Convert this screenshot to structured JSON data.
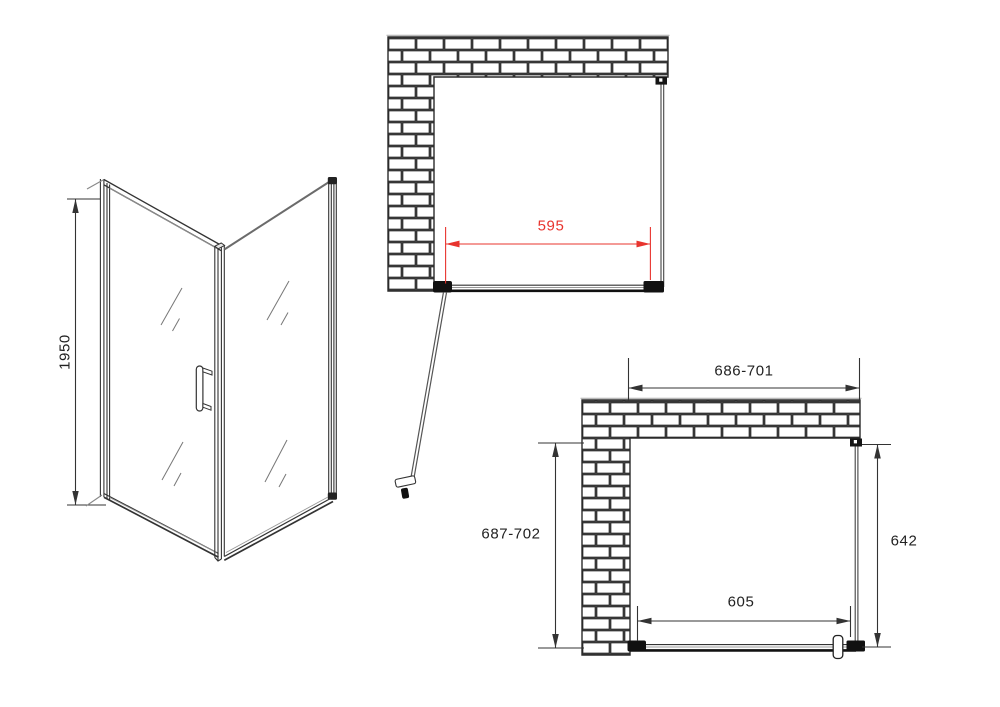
{
  "title": "Shower enclosure technical drawing",
  "colors": {
    "line": "#333333",
    "brick_outline": "#2c2c2c",
    "dimension_red": "#e8342e",
    "dimension_black": "#222222",
    "background": "#ffffff"
  },
  "views": {
    "perspective": {
      "name": "3D perspective view of corner shower enclosure",
      "dims": {
        "height": "1950"
      }
    },
    "plan_upper": {
      "name": "Plan view with door shown open",
      "dims": {
        "door_width": "595"
      }
    },
    "plan_lower": {
      "name": "Plan view with installation ranges",
      "dims": {
        "overall_width": "686-701",
        "overall_depth": "687-702",
        "side_panel": "642",
        "door_opening": "605"
      }
    }
  }
}
